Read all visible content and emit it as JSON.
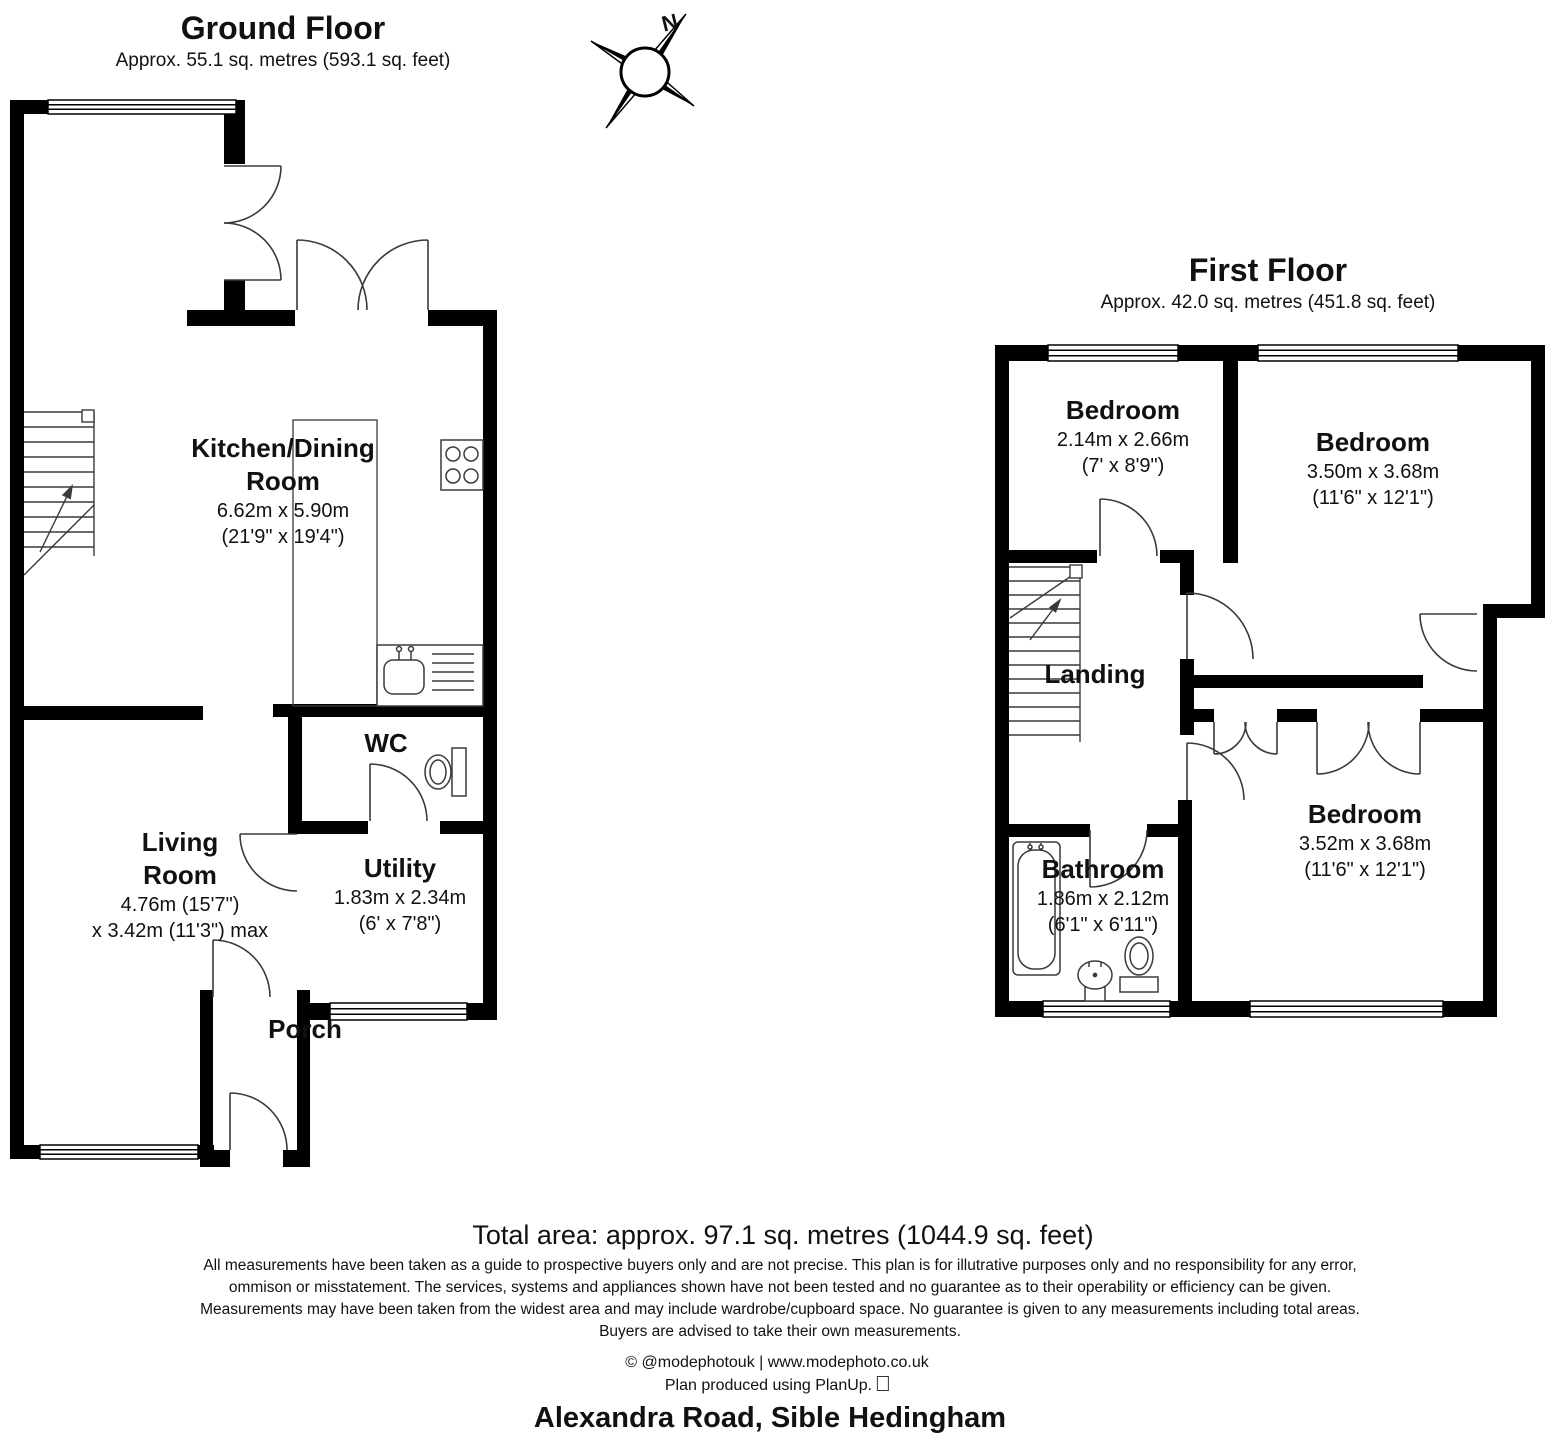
{
  "ground_floor": {
    "title": "Ground Floor",
    "subtitle": "Approx. 55.1 sq. metres (593.1 sq. feet)",
    "rooms": {
      "kitchen": {
        "name1": "Kitchen/Dining",
        "name2": "Room",
        "metric": "6.62m x 5.90m",
        "imperial": "(21'9\" x 19'4\")"
      },
      "living": {
        "name1": "Living",
        "name2": "Room",
        "metric": "4.76m (15'7\")",
        "imperial": "x 3.42m (11'3\") max"
      },
      "wc": {
        "name": "WC"
      },
      "utility": {
        "name": "Utility",
        "metric": "1.83m x 2.34m",
        "imperial": "(6' x 7'8\")"
      },
      "porch": {
        "name": "Porch"
      }
    }
  },
  "first_floor": {
    "title": "First Floor",
    "subtitle": "Approx. 42.0 sq. metres (451.8 sq. feet)",
    "rooms": {
      "bedroom1": {
        "name": "Bedroom",
        "metric": "2.14m x 2.66m",
        "imperial": "(7' x 8'9\")"
      },
      "bedroom2": {
        "name": "Bedroom",
        "metric": "3.50m x 3.68m",
        "imperial": "(11'6\" x 12'1\")"
      },
      "landing": {
        "name": "Landing"
      },
      "bathroom": {
        "name": "Bathroom",
        "metric": "1.86m x 2.12m",
        "imperial": "(6'1\" x 6'11\")"
      },
      "bedroom3": {
        "name": "Bedroom",
        "metric": "3.52m x 3.68m",
        "imperial": "(11'6\" x 12'1\")"
      }
    }
  },
  "compass": {
    "north_label": "N"
  },
  "footer": {
    "total_area": "Total area: approx. 97.1 sq. metres (1044.9 sq. feet)",
    "disclaimer": [
      "All measurements have been taken as a guide to prospective buyers only and are not precise. This plan is for illutrative purposes only and no responsibility for any error,",
      "ommison or misstatement. The services, systems and appliances shown have not been tested and no guarantee as to their operability or efficiency can be given.",
      "Measurements may have been taken from the widest area and may include wardrobe/cupboard space. No guarantee is given to any measurements including total areas.",
      "Buyers are advised to take their own measurements."
    ],
    "credit": "© @modephotouk | www.modephoto.co.uk",
    "produced": "Plan produced using PlanUp.",
    "address": "Alexandra Road, Sible Hedingham"
  }
}
